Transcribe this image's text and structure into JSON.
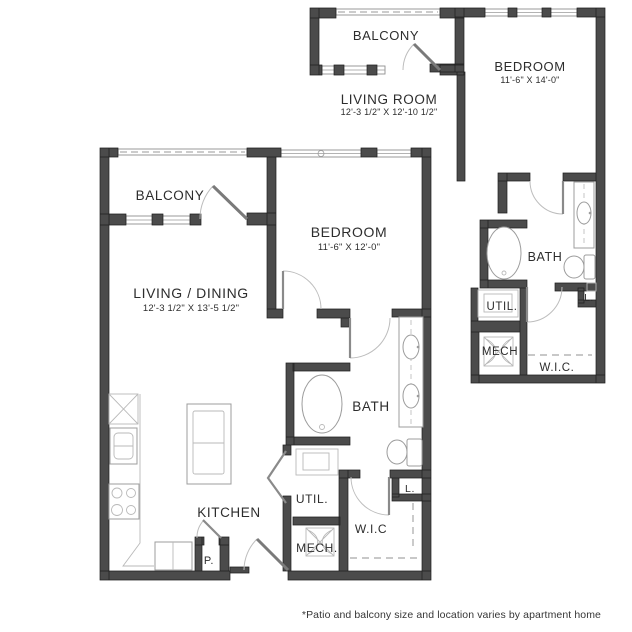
{
  "colors": {
    "wall": "#4b4b4b",
    "fixture_line": "#9c9c9c",
    "text": "#2d2d2d",
    "background": "#ffffff"
  },
  "main_plan": {
    "balcony": {
      "label": "BALCONY"
    },
    "living_dining": {
      "label": "LIVING / DINING",
      "dimensions": "12'-3 1/2\" X 13'-5 1/2\""
    },
    "bedroom": {
      "label": "BEDROOM",
      "dimensions": "11'-6\" X 12'-0\""
    },
    "bath": {
      "label": "BATH"
    },
    "kitchen": {
      "label": "KITCHEN"
    },
    "utility": {
      "label": "UTIL."
    },
    "mechanical": {
      "label": "MECH."
    },
    "walk_in_closet": {
      "label": "W.I.C"
    },
    "pantry": {
      "label": "P."
    },
    "linen": {
      "label": "L."
    }
  },
  "alt_plan": {
    "balcony": {
      "label": "BALCONY"
    },
    "living_room": {
      "label": "LIVING ROOM",
      "dimensions": "12'-3 1/2\" X 12'-10 1/2\""
    },
    "bedroom": {
      "label": "BEDROOM",
      "dimensions": "11'-6\" X 14'-0\""
    },
    "bath": {
      "label": "BATH"
    },
    "utility": {
      "label": "UTIL."
    },
    "mechanical": {
      "label": "MECH"
    },
    "walk_in_closet": {
      "label": "W.I.C."
    },
    "linen": {
      "label": "L."
    }
  },
  "footer": {
    "note": "*Patio and balcony size and location varies by apartment home"
  }
}
